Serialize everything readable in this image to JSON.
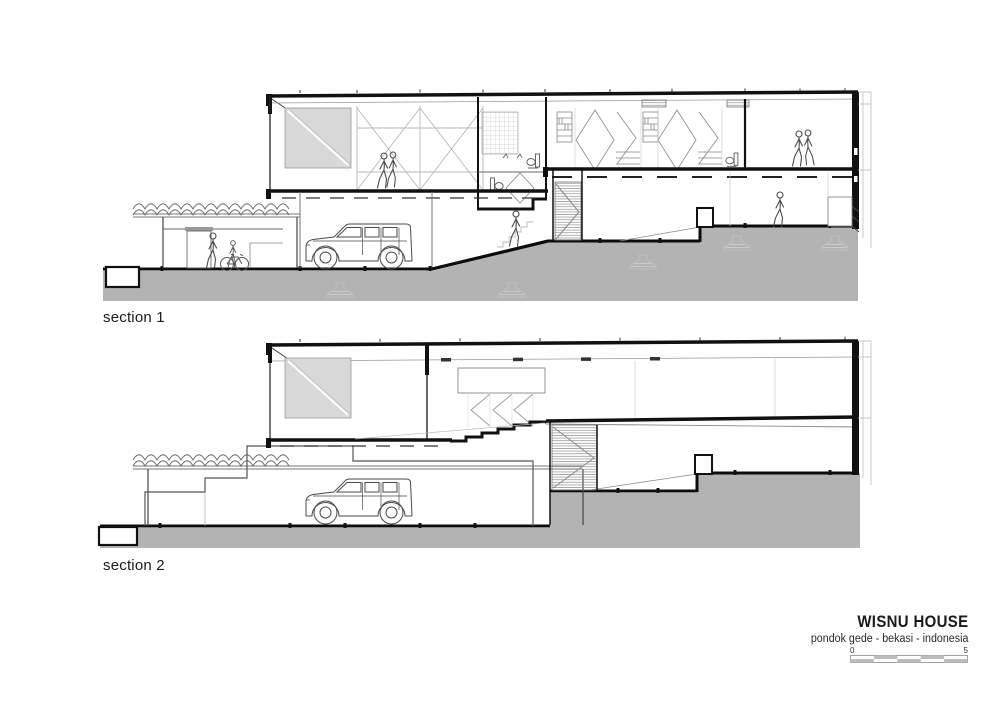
{
  "sections": [
    {
      "label": "section 1"
    },
    {
      "label": "section 2"
    }
  ],
  "titleblock": {
    "project": "WISNU HOUSE",
    "location": "pondok gede - bekasi - indonesia",
    "scale": {
      "start": "0",
      "end": "5"
    }
  },
  "colors": {
    "page": "#ffffff",
    "ground": "#b3b3b3",
    "skylight": "#d8d8d8",
    "ink": "#111111",
    "medium_line": "#555555",
    "light_line": "#9c9c9c",
    "figure": "#4a4a4a",
    "scalebar": "#bdbdbd"
  },
  "icons": {
    "car": "suv-side-view",
    "person": "human-figure-outline",
    "bicycle": "bicycle-side-view",
    "toilet": "wc-fixture-side",
    "vegetation": "pergola-planting-scribble",
    "footing": "foundation-footing",
    "stair": "hatched-stair-flight"
  }
}
